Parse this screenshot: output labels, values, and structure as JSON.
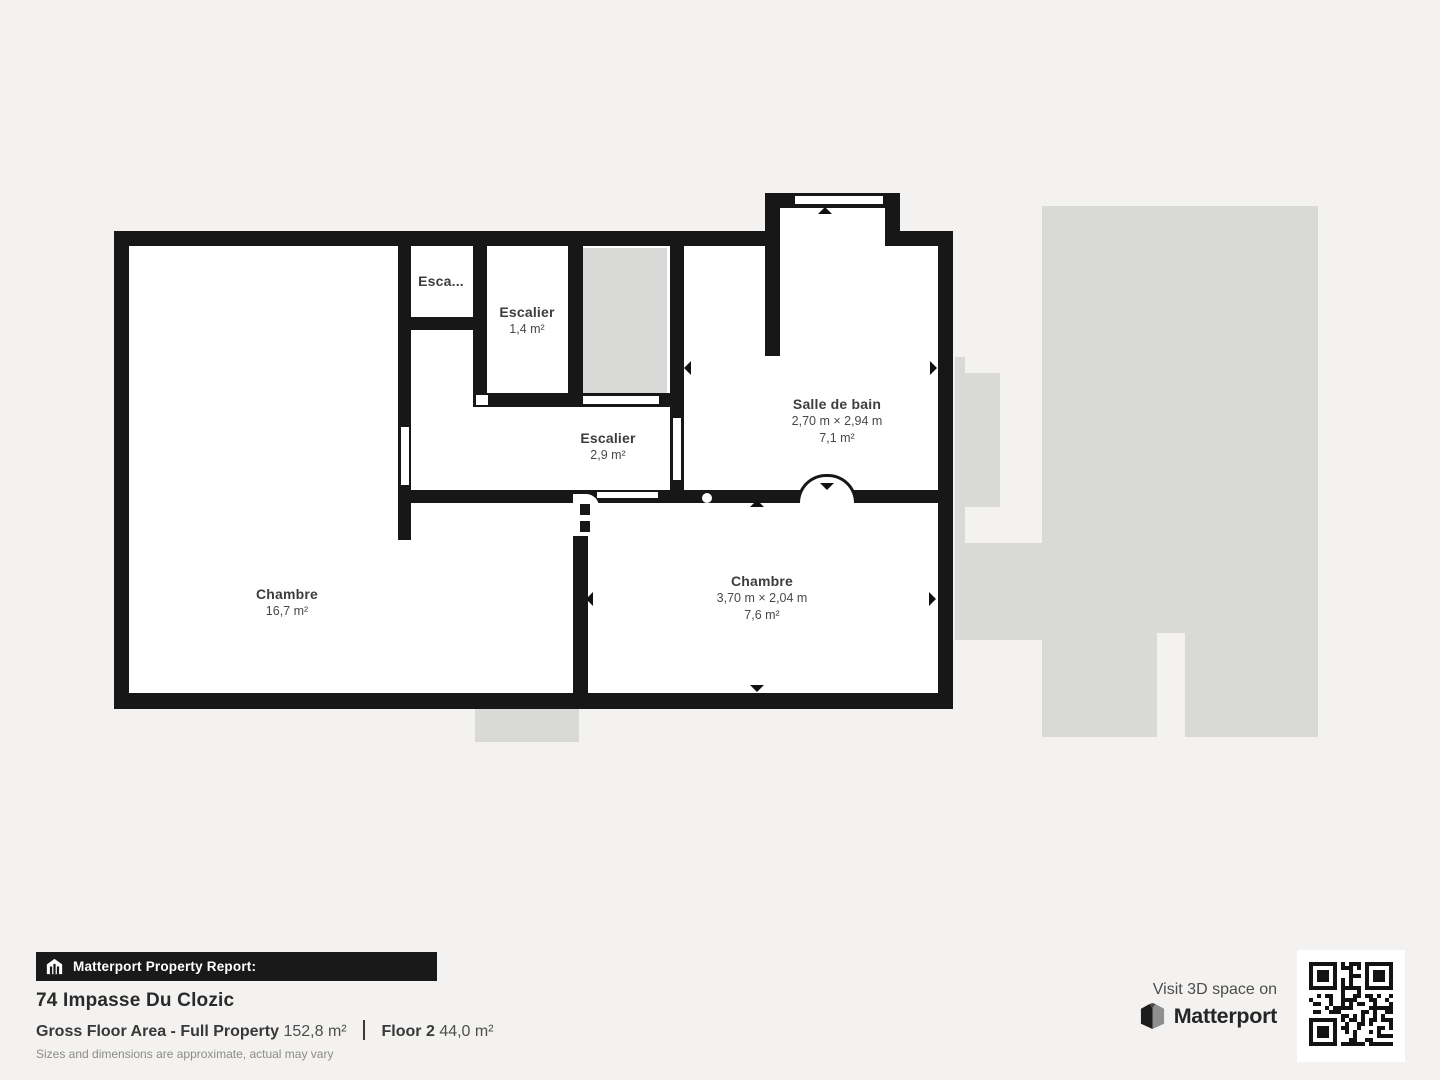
{
  "plan": {
    "colors": {
      "wall": "#171717",
      "floor": "#ffffff",
      "silhouette": "#d9d9d8",
      "background": "#f3f2f0"
    },
    "rooms": {
      "chambre1": {
        "name": "Chambre",
        "area": "16,7 m²"
      },
      "esca": {
        "name": "Esca..."
      },
      "escalier_small": {
        "name": "Escalier",
        "area": "1,4 m²"
      },
      "escalier": {
        "name": "Escalier",
        "area": "2,9 m²"
      },
      "salle_de_bain": {
        "name": "Salle de bain",
        "dims": "2,70 m × 2,94 m",
        "area": "7,1 m²"
      },
      "chambre2": {
        "name": "Chambre",
        "dims": "3,70 m × 2,04 m",
        "area": "7,6 m²"
      }
    }
  },
  "footer": {
    "report_label": "Matterport Property Report:",
    "address": "74 Impasse Du Clozic",
    "stats": {
      "gross_label": "Gross Floor Area - Full Property",
      "gross_value": "152,8 m²",
      "floor_label": "Floor 2",
      "floor_value": "44,0 m²"
    },
    "disclaimer": "Sizes and dimensions are approximate, actual may vary",
    "cta": {
      "visit": "Visit 3D space on",
      "brand": "Matterport"
    }
  },
  "icons": {
    "report_bar": "house-icon",
    "brand": "matterport-logo-icon",
    "qr": "qr-code"
  }
}
